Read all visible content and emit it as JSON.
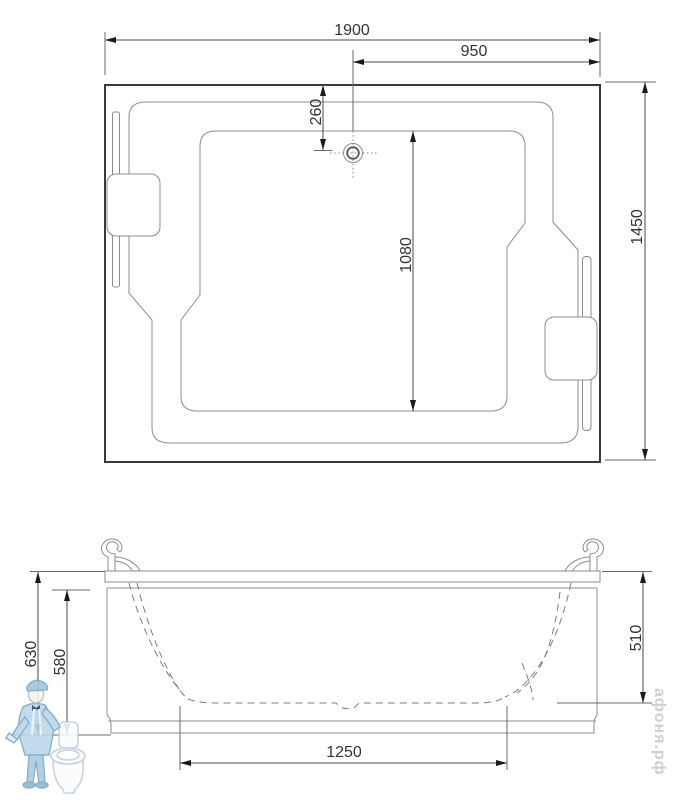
{
  "drawing": {
    "type": "bathtub technical drawing, plan view and front elevation"
  },
  "top_view": {
    "dims": {
      "overall_length": "1900",
      "drain_to_right_edge": "950",
      "top_edge_to_drain": "260",
      "basin_length": "1080",
      "overall_width": "1450"
    }
  },
  "front_view": {
    "dims": {
      "total_height": "630",
      "apron_height": "580",
      "inner_depth": "510",
      "base_length": "1250"
    }
  },
  "watermark": {
    "site": "афоня.рф"
  },
  "colors": {
    "line_dark": "#3a3a3a",
    "line_gray": "#8c8c8c",
    "dim_text": "#333333",
    "watermark_text": "#cfcfcf",
    "watermark_blue": "#bcd8ea",
    "watermark_blue_dark": "#7fa9c4"
  }
}
